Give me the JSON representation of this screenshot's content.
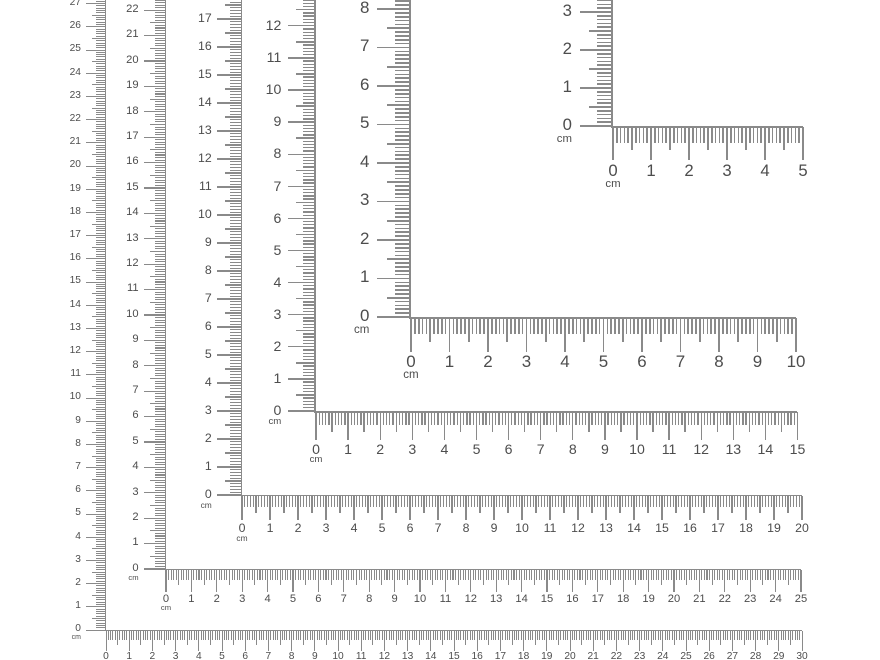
{
  "unit_label": "cm",
  "colors": {
    "background": "#ffffff",
    "tick": "#8a8a8a",
    "text": "#4d4d4d"
  },
  "rulers": [
    {
      "name": "ruler-30cm",
      "length_cm": 30,
      "corner_x": 106,
      "corner_y": 630,
      "px_per_cm": 23.2,
      "horizontal_labels": [
        "0",
        "1",
        "2",
        "3",
        "4",
        "5",
        "6",
        "7",
        "8",
        "9",
        "10",
        "11",
        "12",
        "13",
        "14",
        "15",
        "16",
        "17",
        "18",
        "19",
        "20",
        "21",
        "22",
        "23",
        "24",
        "25",
        "26",
        "27",
        "28",
        "29",
        "30"
      ],
      "vertical_labels": [
        "0",
        "1",
        "2",
        "3",
        "4",
        "5",
        "6",
        "7",
        "8",
        "9",
        "10",
        "11",
        "12",
        "13",
        "14",
        "15",
        "16",
        "17",
        "18",
        "19",
        "20",
        "21",
        "22",
        "23",
        "24",
        "25",
        "26",
        "27"
      ]
    },
    {
      "name": "ruler-25cm",
      "length_cm": 25,
      "corner_x": 166,
      "corner_y": 569,
      "px_per_cm": 25.4,
      "horizontal_labels": [
        "0",
        "1",
        "2",
        "3",
        "4",
        "5",
        "6",
        "7",
        "8",
        "9",
        "10",
        "11",
        "12",
        "13",
        "14",
        "15",
        "16",
        "17",
        "18",
        "19",
        "20",
        "21",
        "22",
        "23",
        "24",
        "25"
      ],
      "vertical_labels": [
        "0",
        "1",
        "2",
        "3",
        "4",
        "5",
        "6",
        "7",
        "8",
        "9",
        "10",
        "11",
        "12",
        "13",
        "14",
        "15",
        "16",
        "17",
        "18",
        "19",
        "20",
        "21",
        "22"
      ]
    },
    {
      "name": "ruler-20cm",
      "length_cm": 20,
      "corner_x": 242,
      "corner_y": 495,
      "px_per_cm": 28.0,
      "horizontal_labels": [
        "0",
        "1",
        "2",
        "3",
        "4",
        "5",
        "6",
        "7",
        "8",
        "9",
        "10",
        "11",
        "12",
        "13",
        "14",
        "15",
        "16",
        "17",
        "18",
        "19",
        "20"
      ],
      "vertical_labels": [
        "0",
        "1",
        "2",
        "3",
        "4",
        "5",
        "6",
        "7",
        "8",
        "9",
        "10",
        "11",
        "12",
        "13",
        "14",
        "15",
        "16",
        "17"
      ]
    },
    {
      "name": "ruler-15cm",
      "length_cm": 15,
      "corner_x": 316,
      "corner_y": 411,
      "px_per_cm": 32.1,
      "horizontal_labels": [
        "0",
        "1",
        "2",
        "3",
        "4",
        "5",
        "6",
        "7",
        "8",
        "9",
        "10",
        "11",
        "12",
        "13",
        "14",
        "15"
      ],
      "vertical_labels": [
        "0",
        "1",
        "2",
        "3",
        "4",
        "5",
        "6",
        "7",
        "8",
        "9",
        "10",
        "11",
        "12",
        "13"
      ]
    },
    {
      "name": "ruler-10cm",
      "length_cm": 10,
      "corner_x": 411,
      "corner_y": 317,
      "px_per_cm": 38.5,
      "horizontal_labels": [
        "0",
        "1",
        "2",
        "3",
        "4",
        "5",
        "6",
        "7",
        "8",
        "9",
        "10"
      ],
      "vertical_labels": [
        "0",
        "1",
        "2",
        "3",
        "4",
        "5",
        "6",
        "7",
        "8"
      ]
    },
    {
      "name": "ruler-5cm",
      "length_cm": 5,
      "corner_x": 613,
      "corner_y": 126,
      "px_per_cm": 38.0,
      "horizontal_labels": [
        "0",
        "1",
        "2",
        "3",
        "4",
        "5"
      ],
      "vertical_labels": [
        "0",
        "1",
        "2",
        "3"
      ]
    }
  ]
}
